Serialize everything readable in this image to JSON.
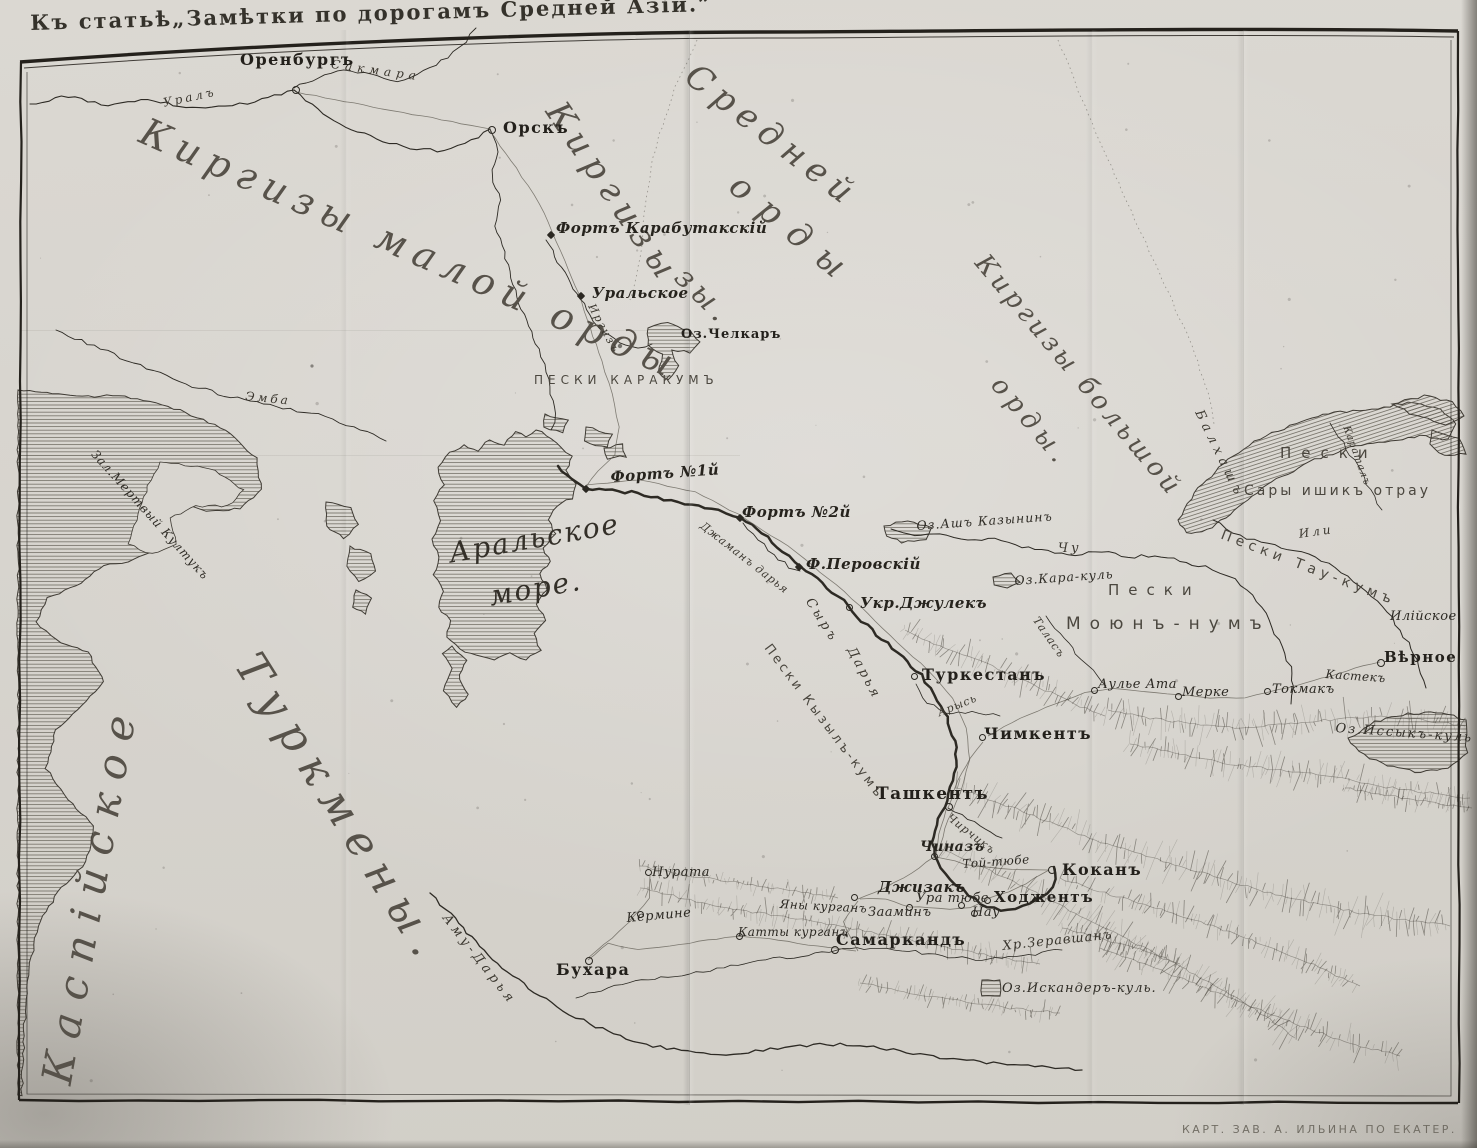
{
  "page": {
    "title": "Къ статьѣ„Замѣтки по дорогамъ Средней Азій.”",
    "imprint": "КАРТ. ЗАВ. А. ИЛЬИНА ПО ЕКАТЕР."
  },
  "colors": {
    "paper": "#d9d6d0",
    "ink": "#2d2a24",
    "hatch": "#6b675e",
    "accent": "#45413a"
  },
  "labels": {
    "ural_river": "Уралъ",
    "sakmara": "Сакмара",
    "orenburg": "Оренбургъ",
    "orsk": "Орскъ",
    "kirgiz_small": "Киргизы малой орды",
    "kirgiz_mid_a": "Средней",
    "kirgiz_mid_b": "Киргизы",
    "kirgiz_mid_c": "орды",
    "kirgiz_mid_d": "зы.",
    "kirgiz_big_a": "Киргизы большой",
    "kirgiz_big_b": "орды.",
    "fort_karabutak": "Фортъ Карабутакскій",
    "uralskoe": "Уральское",
    "irgiz": "Иргизъ",
    "lake_chelkar": "Оз.Челкаръ",
    "peski_karakum": "ПЕСКИ КАРАКУМЪ",
    "emba": "Эмба",
    "kultuk": "Зал.Мертвый Култукъ",
    "aral_a": "Аральское",
    "aral_b": "море.",
    "fort1": "Фортъ №1й",
    "fort2": "Фортъ №2й",
    "dzhaman": "Джаманъ дарья",
    "perovsky": "Ф.Перовскій",
    "syr": "Сыръ",
    "darya": "Дарья",
    "dzhulek": "Укр.Джулекъ",
    "kyzylkum": "Пески Кызылъ-кумъ",
    "turkestan": "Туркестанъ",
    "ash": "Оз.Ашъ Казынинъ",
    "chu": "Чу",
    "karakul": "Оз.Кара-куль",
    "peski_m": "Пески",
    "moyun": "Моюнъ-нумъ",
    "talas": "Таласъ",
    "balkhash": "Балхашъ",
    "peski_s": "Пески",
    "sary": "Сары ишикъ отрау",
    "karatal": "Караталъ",
    "ili_r": "Или",
    "taukum": "Пески Тау-кумъ",
    "iliyskoe": "Илійское",
    "vernoe": "Вѣрное",
    "kastek": "Кастекъ",
    "tokmak": "Токмакъ",
    "issykkul": "Оз.Иссыкъ-куль",
    "aulie": "Аулье Ата",
    "merke": "Мерке",
    "chimkent": "Чимкентъ",
    "arys": "Арысь",
    "tashkent": "Ташкентъ",
    "chirchik": "Чирчикъ",
    "chinaz": "Чиназъ",
    "toi": "Той-тюбе",
    "kokan": "Коканъ",
    "khodzhent": "Ходжентъ",
    "uratube": "Ура тюбе",
    "nau": "Нау",
    "zaamin": "Зааминъ",
    "dzhizak": "Джизакъ",
    "samarkand": "Самаркандъ",
    "zeravshan": "Хр.Зеравшанъ",
    "iskander": "Оз.Искандеръ-куль.",
    "yany": "Яны курганъ",
    "katty": "Катты курганъ",
    "kermine": "Кермине",
    "bukhara": "Бухара",
    "nurata": "Нурата",
    "amu": "Аму-Дарья",
    "turkmen": "Туркмены.",
    "caspian": "Каспійское"
  }
}
